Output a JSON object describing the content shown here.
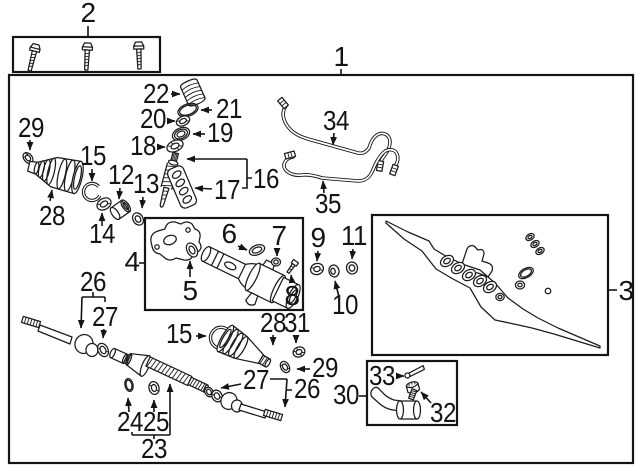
{
  "diagram": {
    "background_color": "#ffffff",
    "line_color": "#141414",
    "callouts": {
      "n1": "1",
      "n2": "2",
      "n3": "3",
      "n4": "4",
      "n5": "5",
      "n6": "6",
      "n7": "7",
      "n8": "8",
      "n9": "9",
      "n10": "10",
      "n11": "11",
      "n12": "12",
      "n13": "13",
      "n14": "14",
      "n15a": "15",
      "n15b": "15",
      "n16": "16",
      "n17": "17",
      "n18": "18",
      "n19": "19",
      "n20": "20",
      "n21": "21",
      "n22": "22",
      "n23": "23",
      "n24": "24",
      "n25": "25",
      "n26a": "26",
      "n26b": "26",
      "n27a": "27",
      "n27b": "27",
      "n28a": "28",
      "n28b": "28",
      "n29a": "29",
      "n29b": "29",
      "n30": "30",
      "n31": "31",
      "n32": "32",
      "n33": "33",
      "n34": "34",
      "n35": "35"
    }
  }
}
